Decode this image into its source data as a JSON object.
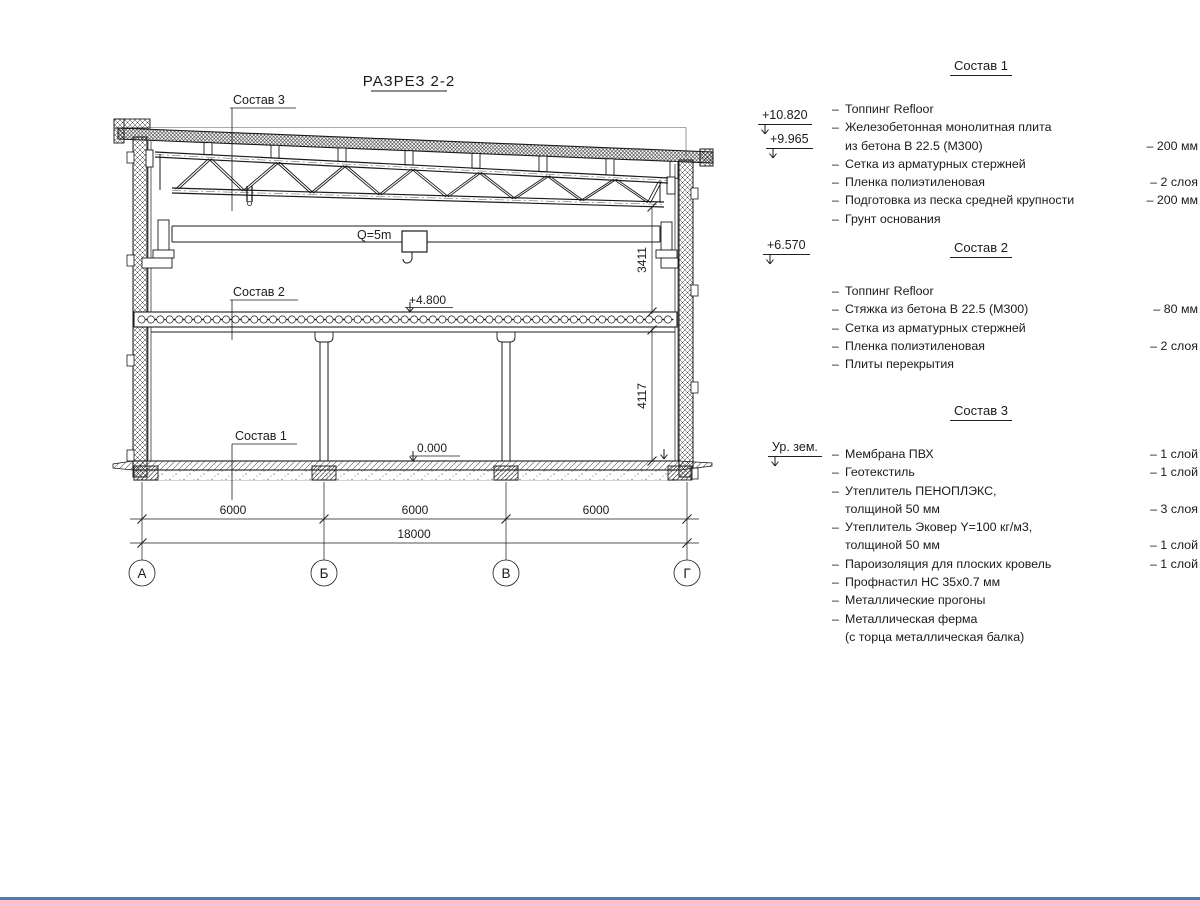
{
  "drawing": {
    "title": "РАЗРЕЗ 2-2",
    "callout_3": "Состав 3",
    "callout_2": "Состав 2",
    "callout_1": "Состав 1",
    "crane_label": "Q=5m",
    "elev_slab": "+4.800",
    "elev_floor": "0.000",
    "dim_truss_clearance": "3411",
    "dim_floor_height": "4117",
    "dim_spans": [
      "6000",
      "6000",
      "6000"
    ],
    "dim_total": "18000",
    "axes": [
      "А",
      "Б",
      "В",
      "Г"
    ]
  },
  "legend": {
    "elevations": [
      {
        "label": "+10.820"
      },
      {
        "label": "+9.965"
      },
      {
        "label": "+6.570"
      },
      {
        "label": "Ур. зем."
      }
    ],
    "sections": [
      {
        "title": "Состав 1",
        "items": [
          {
            "text": "Топпинг Refloor",
            "value": ""
          },
          {
            "text": "Железобетонная  монолитная плита",
            "value": ""
          },
          {
            "text": "из бетона В 22.5 (М300)",
            "value": "– 200 мм",
            "indent": true
          },
          {
            "text": "Сетка из арматурных стержней",
            "value": ""
          },
          {
            "text": "Пленка полиэтиленовая",
            "value": "– 2 слоя"
          },
          {
            "text": "Подготовка из песка средней крупности",
            "value": "– 200 мм"
          },
          {
            "text": "Грунт основания",
            "value": ""
          }
        ]
      },
      {
        "title": "Состав 2",
        "items": [
          {
            "text": "Топпинг Refloor",
            "value": ""
          },
          {
            "text": "Стяжка из бетона В 22.5 (М300)",
            "value": "– 80 мм"
          },
          {
            "text": "Сетка из арматурных стержней",
            "value": ""
          },
          {
            "text": "Пленка полиэтиленовая",
            "value": "– 2 слоя"
          },
          {
            "text": "Плиты перекрытия",
            "value": ""
          }
        ]
      },
      {
        "title": "Состав 3",
        "items": [
          {
            "text": "Мембрана ПВХ",
            "value": "– 1 слой"
          },
          {
            "text": "Геотекстиль",
            "value": "– 1 слой"
          },
          {
            "text": "Утеплитель ПЕНОПЛЭКС,",
            "value": ""
          },
          {
            "text": "толщиной 50 мм",
            "value": "– 3 слоя",
            "indent": true
          },
          {
            "text": "Утеплитель Эковер Y=100 кг/м3,",
            "value": ""
          },
          {
            "text": "толщиной 50 мм",
            "value": "– 1 слой",
            "indent": true
          },
          {
            "text": "Пароизоляция для плоских кровель",
            "value": "– 1 слой"
          },
          {
            "text": "Профнастил НС 35х0.7 мм",
            "value": ""
          },
          {
            "text": "Металлические прогоны",
            "value": ""
          },
          {
            "text": "Металлическая ферма",
            "value": ""
          },
          {
            "text": "(с торца металлическая балка)",
            "value": "",
            "indent": true
          }
        ]
      }
    ]
  }
}
